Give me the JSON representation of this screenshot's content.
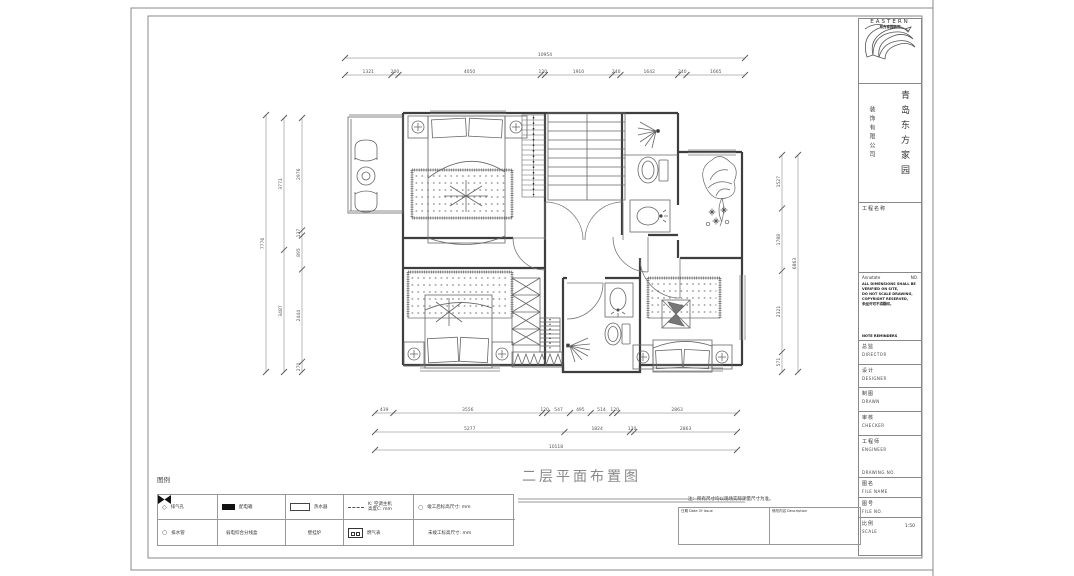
{
  "sheet": {
    "drawing_title": "二层平面布置图",
    "legend_label": "图例",
    "note": "注：所有尺寸均以现场实际测量尺寸为准。",
    "revision_table": {
      "col1_header": "日期 Date Of Issue",
      "col2_header": "修改内容 Description"
    }
  },
  "title_block": {
    "logo_text": "EASTERN",
    "logo_subtext": "东方家园装饰",
    "company_name_cn": "青岛东方家园",
    "company_suffix_cn": "装饰有限公司",
    "project_label": "工程名称",
    "annotate": {
      "title": "Annotate",
      "no_label": "NO.",
      "lines": [
        "ALL DIMENSIONS SHALL BE",
        "VERIFIED ON SITE,",
        "DO NOT SCALE DRAWING,",
        "COPYRIGHT RESERVED,",
        "未经许可不得翻印。"
      ],
      "footer": "NOTE REMINDERS"
    },
    "fields": [
      {
        "cn": "总监",
        "en": "DIRECTOR"
      },
      {
        "cn": "设计",
        "en": "DESIGNER"
      },
      {
        "cn": "制图",
        "en": "DRAWN"
      },
      {
        "cn": "审核",
        "en": "CHECKER"
      },
      {
        "cn": "工程师",
        "en": "ENGINEER",
        "extra": "DRAWING NO."
      },
      {
        "cn": "图名",
        "en": "FILE NAME"
      },
      {
        "cn": "图号",
        "en": "FILE NO."
      },
      {
        "cn": "比例",
        "en": "SCALE",
        "value": "1:50"
      }
    ]
  },
  "legend": {
    "rows": [
      [
        {
          "icon": "diamond",
          "label": "排气孔"
        },
        {
          "icon": "filled-rect",
          "label": "配电箱"
        },
        {
          "icon": "rect",
          "label": "热水器"
        },
        {
          "icon": "dashed-line",
          "label": "K: 空调主机",
          "label2": "高度C: mm"
        },
        {
          "icon": "circle-small",
          "label": "竣工后标高尺寸: mm"
        }
      ],
      [
        {
          "icon": "circle",
          "label": "排水管"
        },
        {
          "icon": "bowtie",
          "label": "弱电综合分线盒"
        },
        {
          "icon": "none",
          "label": "壁挂炉"
        },
        {
          "icon": "meter",
          "label": "燃气表"
        },
        {
          "icon": "none",
          "label": "未竣工标高尺寸: mm"
        }
      ]
    ]
  },
  "dimensions": {
    "top_overall": "10954",
    "top_segments": [
      "1321",
      "200",
      "4050",
      "120",
      "1910",
      "240",
      "1642",
      "240",
      "1665"
    ],
    "bottom_row1": [
      "439",
      "3556",
      "120",
      "547",
      "495",
      "514",
      "120",
      "2863"
    ],
    "bottom_row2": [
      "5277",
      "1824",
      "120",
      "2863"
    ],
    "bottom_overall": "10118",
    "left_inner": [
      "2976",
      "137",
      "895",
      "2444",
      "270"
    ],
    "left_middle": [
      "3771",
      "3487"
    ],
    "left_overall": "7776",
    "right_inner": [
      "1527",
      "1788",
      "2321",
      "571"
    ],
    "right_overall": "6863"
  }
}
